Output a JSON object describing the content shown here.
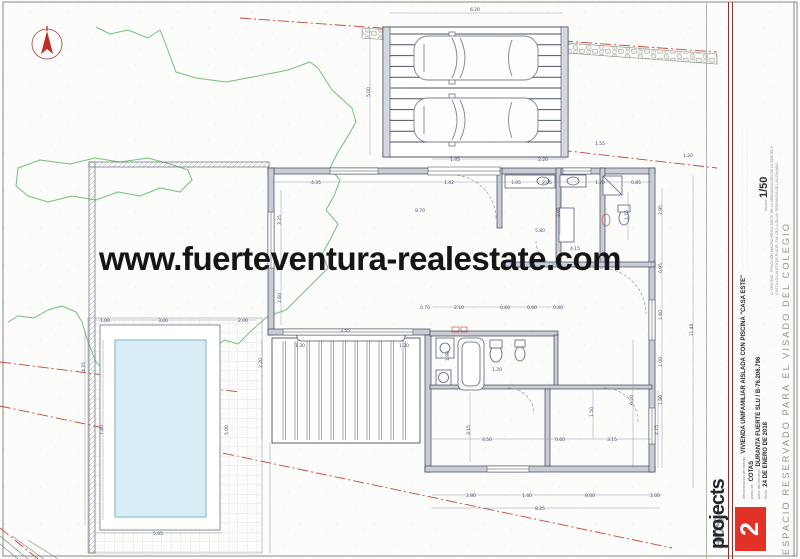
{
  "watermark": "www.fuerteventura-realestate.com",
  "title_block": {
    "logo_acs": "acs",
    "logo_projects": "projects",
    "sheet_number": "2",
    "scale_label": "escala",
    "scale_value": "1/50",
    "reserved_text": "ESPACIO RESERVADO PARA EL VISADO DEL COLEGIO",
    "fields": {
      "denominacion_label": "denominación del trabajo",
      "denominacion_value": "VIVIENDA UNIFAMILIAR AISLADA CON PISCINA \"CASA ESTE\"",
      "plano_label": "plano de",
      "plano_value": "COTAS",
      "autor_label": "autor del encargo",
      "autor_value": "DURANTA FUERTE SLU / B-76.206.796",
      "fecha_label": "fecha",
      "fecha_value": "24 DE ENERO DE 2018",
      "situacion_line1": "C/ CENTRAL, FRACCIÓN MACRO RESULTANTE DE LA URBANIZACIÓN DE LA PARCELA",
      "situacion_line2": "CASTILLO CALETA DE FUSTE, T.M. DE LA OLIVA, PROVINCIA DE LAS PALMAS",
      "fineprint1": "··························································································",
      "fineprint2": "··························································································"
    }
  },
  "colors": {
    "wall_fill": "#c8ccd4",
    "line": "#3d4454",
    "dim_text": "#3d4a6b",
    "contour_green": "#79bd7e",
    "boundary_red": "#c4453c",
    "pool_water": "#d9edf6",
    "pool_edge": "#7fb2cc",
    "sheet_badge": "#e23126",
    "title_rule": "#8a3030"
  },
  "dimensions": [
    {
      "x": 475,
      "y": 11,
      "r": 0,
      "v": "6.20"
    },
    {
      "x": 370,
      "y": 92,
      "r": 1,
      "v": "5.00"
    },
    {
      "x": 455,
      "y": 161,
      "r": 0,
      "v": "1.45"
    },
    {
      "x": 543,
      "y": 161,
      "r": 0,
      "v": "2.20"
    },
    {
      "x": 600,
      "y": 145,
      "r": 0,
      "v": "1.55"
    },
    {
      "x": 688,
      "y": 157,
      "r": 0,
      "v": "1.20"
    },
    {
      "x": 316,
      "y": 184,
      "r": 0,
      "v": "4.35"
    },
    {
      "x": 449,
      "y": 184,
      "r": 0,
      "v": "1.42"
    },
    {
      "x": 516,
      "y": 184,
      "r": 0,
      "v": "1.05"
    },
    {
      "x": 547,
      "y": 184,
      "r": 0,
      "v": "2.05"
    },
    {
      "x": 600,
      "y": 184,
      "r": 0,
      "v": "1.20"
    },
    {
      "x": 636,
      "y": 184,
      "r": 0,
      "v": "0.85"
    },
    {
      "x": 420,
      "y": 212,
      "r": 0,
      "v": "8.70"
    },
    {
      "x": 540,
      "y": 232,
      "r": 0,
      "v": "5.80"
    },
    {
      "x": 575,
      "y": 250,
      "r": 0,
      "v": "4.15"
    },
    {
      "x": 281,
      "y": 220,
      "r": 1,
      "v": "3.25"
    },
    {
      "x": 281,
      "y": 298,
      "r": 1,
      "v": "2.60"
    },
    {
      "x": 262,
      "y": 363,
      "r": 1,
      "v": "2.20"
    },
    {
      "x": 85,
      "y": 367,
      "r": 1,
      "v": "4.25"
    },
    {
      "x": 103,
      "y": 430,
      "r": 1,
      "v": "7.40"
    },
    {
      "x": 105,
      "y": 322,
      "r": 0,
      "v": "1.00"
    },
    {
      "x": 163,
      "y": 322,
      "r": 0,
      "v": "3.00"
    },
    {
      "x": 243,
      "y": 322,
      "r": 0,
      "v": "2.00"
    },
    {
      "x": 158,
      "y": 535,
      "r": 0,
      "v": "5.05"
    },
    {
      "x": 228,
      "y": 430,
      "r": 1,
      "v": "5.00"
    },
    {
      "x": 345,
      "y": 332,
      "r": 0,
      "v": "3.55"
    },
    {
      "x": 300,
      "y": 347,
      "r": 0,
      "v": "1.30"
    },
    {
      "x": 404,
      "y": 347,
      "r": 0,
      "v": "1.20"
    },
    {
      "x": 425,
      "y": 309,
      "r": 0,
      "v": "0.70"
    },
    {
      "x": 459,
      "y": 309,
      "r": 0,
      "v": "2.10"
    },
    {
      "x": 505,
      "y": 309,
      "r": 0,
      "v": "0.60"
    },
    {
      "x": 532,
      "y": 309,
      "r": 0,
      "v": "0.60"
    },
    {
      "x": 558,
      "y": 309,
      "r": 0,
      "v": "0.40"
    },
    {
      "x": 449,
      "y": 356,
      "r": 1,
      "v": "1.90"
    },
    {
      "x": 497,
      "y": 371,
      "r": 0,
      "v": "1.20"
    },
    {
      "x": 470,
      "y": 430,
      "r": 1,
      "v": "3.15"
    },
    {
      "x": 487,
      "y": 441,
      "r": 0,
      "v": "4.50"
    },
    {
      "x": 560,
      "y": 441,
      "r": 0,
      "v": "0.60"
    },
    {
      "x": 612,
      "y": 441,
      "r": 0,
      "v": "3.15"
    },
    {
      "x": 593,
      "y": 412,
      "r": 1,
      "v": "1.50"
    },
    {
      "x": 633,
      "y": 400,
      "r": 1,
      "v": "6.20"
    },
    {
      "x": 658,
      "y": 430,
      "r": 1,
      "v": "2.75"
    },
    {
      "x": 471,
      "y": 497,
      "r": 0,
      "v": "2.80"
    },
    {
      "x": 527,
      "y": 497,
      "r": 0,
      "v": "1.40"
    },
    {
      "x": 590,
      "y": 497,
      "r": 0,
      "v": "8.00"
    },
    {
      "x": 655,
      "y": 497,
      "r": 0,
      "v": "2.00"
    },
    {
      "x": 540,
      "y": 510,
      "r": 0,
      "v": "8.25"
    },
    {
      "x": 662,
      "y": 210,
      "r": 1,
      "v": "2.95"
    },
    {
      "x": 662,
      "y": 268,
      "r": 1,
      "v": "0.95"
    },
    {
      "x": 662,
      "y": 315,
      "r": 1,
      "v": "1.60"
    },
    {
      "x": 662,
      "y": 362,
      "r": 1,
      "v": "1.00"
    },
    {
      "x": 662,
      "y": 400,
      "r": 1,
      "v": "1.80"
    },
    {
      "x": 693,
      "y": 330,
      "r": 1,
      "v": "11.40"
    },
    {
      "x": 628,
      "y": 215,
      "r": 1,
      "v": "1.75"
    },
    {
      "x": 560,
      "y": 212,
      "r": 1,
      "v": "2.05"
    }
  ]
}
